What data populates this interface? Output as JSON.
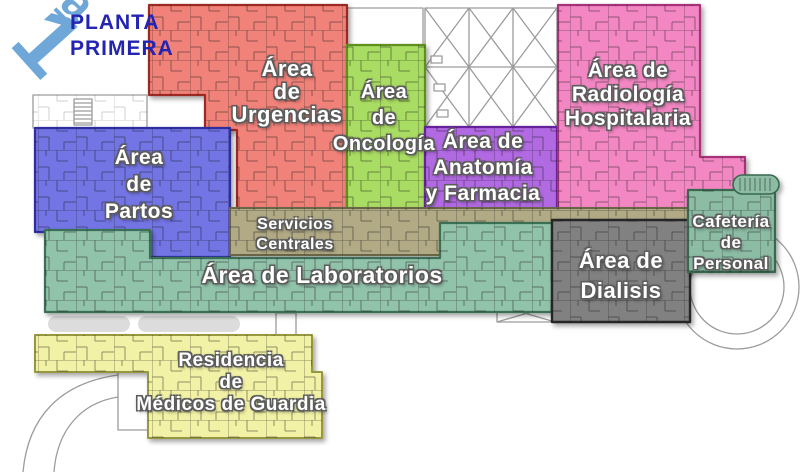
{
  "page": {
    "title_line1": "PLANTA",
    "title_line2": "PRIMERA",
    "badge_digit": "1",
    "badge_sup": "a"
  },
  "palette": {
    "title_blue": "#2424B2",
    "badge_blue": "#6FA8D8",
    "outline": "#9C9C9C",
    "corridor": "#DCDCDC"
  },
  "regions": {
    "urgencias": {
      "lines": [
        "Área",
        "de",
        "Urgencias"
      ],
      "fill": "#F1827A",
      "stroke": "#9C2B23"
    },
    "oncologia": {
      "lines": [
        "Área",
        "de",
        "Oncología"
      ],
      "fill": "#A9DC62",
      "stroke": "#5E8F1E"
    },
    "partos": {
      "lines": [
        "Área",
        "de",
        "Partos"
      ],
      "fill": "#7375E5",
      "stroke": "#2D2F9E"
    },
    "anatomia": {
      "lines": [
        "Área de",
        "Anatomía",
        "y Farmacia"
      ],
      "fill": "#B26AE3",
      "stroke": "#66249B"
    },
    "radiologia": {
      "lines": [
        "Área de",
        "Radiología",
        "Hospitalaria"
      ],
      "fill": "#F287C3",
      "stroke": "#A63278"
    },
    "servicios": {
      "lines": [
        "Servicios",
        "Centrales"
      ],
      "fill": "#B1AA85",
      "stroke": "#6B6546"
    },
    "laboratorios": {
      "lines": [
        "Área de Laboratorios"
      ],
      "fill": "#91C2AA",
      "stroke": "#3A6F57"
    },
    "dialisis": {
      "lines": [
        "Área de",
        "Dialisis"
      ],
      "fill": "#818181",
      "stroke": "#262626"
    },
    "cafeteria": {
      "lines": [
        "Cafetería",
        "de",
        "Personal"
      ],
      "fill": "#8CBCA4",
      "stroke": "#38684F"
    },
    "residencia": {
      "lines": [
        "Residencia",
        "de",
        "Médicos de Guardia"
      ],
      "fill": "#F2F2A6",
      "stroke": "#97973F"
    }
  }
}
